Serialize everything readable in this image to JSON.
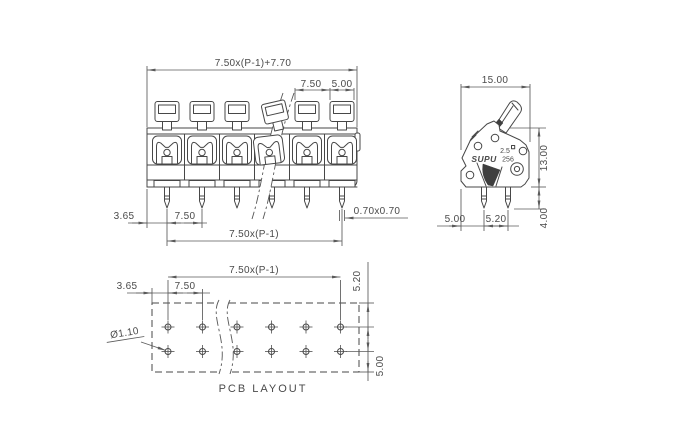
{
  "colors": {
    "background": "#ffffff",
    "line": "#474747",
    "dim_line": "#5a5a5a",
    "text": "#4a4a4a"
  },
  "front_view": {
    "dim_overall": "7.50x(P-1)+7.70",
    "dim_pitch_top": "7.50",
    "dim_pole_width": "5.00",
    "dim_pin_offset": "3.65",
    "dim_pin_pitch": "7.50",
    "dim_pin_span": "7.50x(P-1)",
    "dim_pin_section": "0.70x0.70"
  },
  "side_view": {
    "dim_width": "15.00",
    "dim_height": "13.00",
    "dim_pin_length": "4.00",
    "dim_front_to_pin": "5.00",
    "dim_row_pitch": "5.20",
    "brand": "SUPU",
    "marking_wire_size": "2.5",
    "marking_series": "256"
  },
  "pcb_layout": {
    "dim_hole_span": "7.50x(P-1)",
    "dim_edge_offset": "3.65",
    "dim_hole_pitch": "7.50",
    "dim_row_pitch": "5.20",
    "dim_row_edge": "5.00",
    "dim_hole_diameter": "Ø1.10",
    "caption": "PCB LAYOUT"
  }
}
